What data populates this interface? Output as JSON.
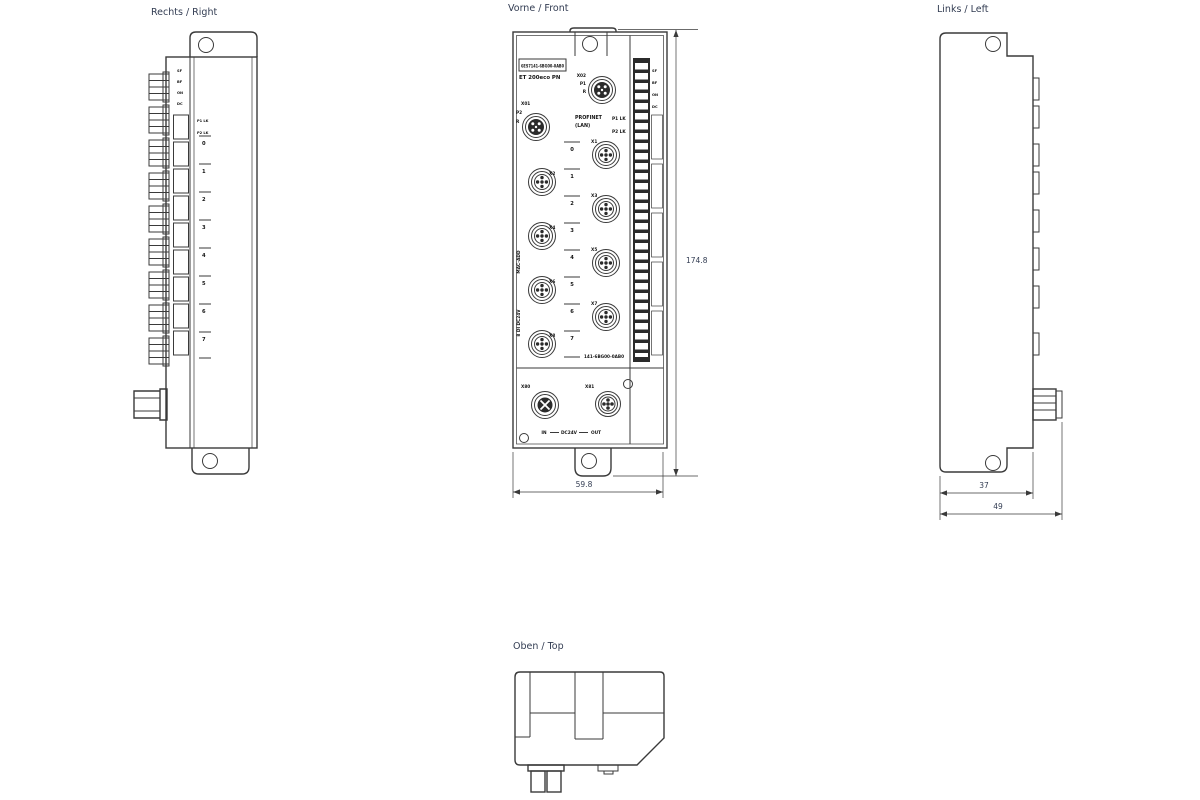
{
  "views": {
    "right": {
      "title": "Rechts / Right",
      "led_marks": [
        "SF",
        "BF",
        "ON",
        "DC"
      ],
      "link_labels": [
        "P1 LK",
        "P2 LK"
      ],
      "channels": [
        "0",
        "1",
        "2",
        "3",
        "4",
        "5",
        "6",
        "7"
      ]
    },
    "front": {
      "title": "Vorne / Front",
      "article_number": "6ES7141-6BG00-0AB0",
      "product_name": "ET 200eco PN",
      "port_top": {
        "line1": "X02",
        "line2": "P1",
        "line3": "R"
      },
      "port_left": {
        "line1": "X01",
        "line2": "P2",
        "line3": "R"
      },
      "profinet_line1": "PROFINET",
      "profinet_line2": "(LAN)",
      "led_labels": [
        "P1 LK",
        "P2 LK"
      ],
      "led_marks": [
        "SF",
        "BF",
        "ON",
        "DC"
      ],
      "ports_left_column": [
        "X2",
        "X4",
        "X6",
        "X8"
      ],
      "ports_right_column": [
        "X1",
        "X3",
        "X5",
        "X7"
      ],
      "channels": [
        "0",
        "1",
        "2",
        "3",
        "4",
        "5",
        "6",
        "7"
      ],
      "side_print_upper": "MAC-ADD",
      "side_print_lower": "8 DI DC24V",
      "bottom_print": "141-6BG00-0AB0",
      "power_in": "X80",
      "power_out": "X81",
      "power_caption": {
        "in": "IN",
        "mid": "DC24V",
        "out": "OUT"
      },
      "dims": {
        "height": "174.8",
        "width": "59.8"
      }
    },
    "left": {
      "title": "Links / Left",
      "dims": {
        "body_depth": "37",
        "total_depth": "49"
      }
    },
    "top": {
      "title": "Oben / Top"
    }
  }
}
